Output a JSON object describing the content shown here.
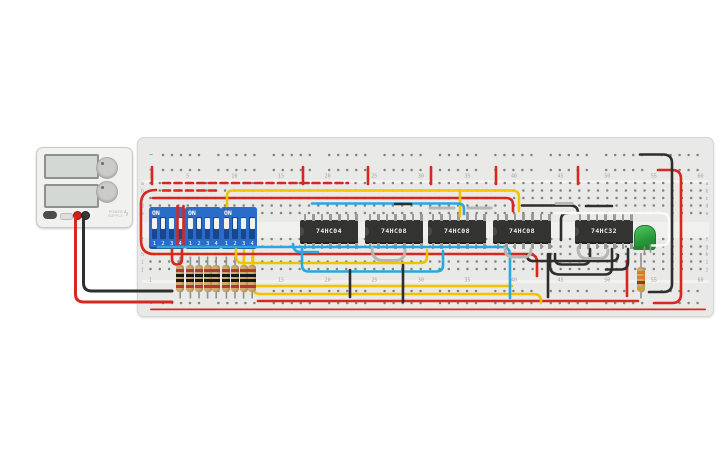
{
  "power_supply": {
    "brand_line1": "POWER",
    "brand_line2": "SUPPLY",
    "power_glyph": "ϟ"
  },
  "breadboard": {
    "column_numbers": [
      "1",
      "5",
      "10",
      "15",
      "20",
      "25",
      "30",
      "35",
      "40",
      "45",
      "50",
      "55",
      "60"
    ],
    "row_letters_top": [
      "a",
      "b",
      "c",
      "d",
      "e"
    ],
    "row_letters_bottom": [
      "f",
      "g",
      "h",
      "i",
      "j"
    ],
    "minus_symbol": "−",
    "plus_symbol": "+"
  },
  "dip_switches": [
    {
      "on_label": "ON",
      "pins": [
        "1",
        "2",
        "3",
        "4"
      ],
      "states": [
        "on",
        "on",
        "on",
        "on"
      ]
    },
    {
      "on_label": "ON",
      "pins": [
        "1",
        "2",
        "3",
        "4"
      ],
      "states": [
        "on",
        "on",
        "on",
        "on"
      ]
    },
    {
      "on_label": "ON",
      "pins": [
        "1",
        "2",
        "3",
        "4"
      ],
      "states": [
        "on",
        "on",
        "on",
        "on"
      ]
    }
  ],
  "ics": [
    {
      "label": "74HC04"
    },
    {
      "label": "74HC08"
    },
    {
      "label": "74HC08"
    },
    {
      "label": "74HC08"
    },
    {
      "label": "74HC32"
    }
  ],
  "led": {
    "color": "green"
  },
  "resistors": {
    "left_count": 9,
    "left_bands": [
      "#b03a2e",
      "#161616",
      "#161616",
      "#b03a2e"
    ],
    "right_bands": [
      "#e07b20",
      "#e07b20",
      "#7a4a12",
      "#c8a038"
    ]
  },
  "wires": [
    {
      "c": "#d6281e",
      "w": 2.6,
      "layer": "under",
      "d": "M258 301 H638"
    },
    {
      "c": "#f0c400",
      "w": 2.6,
      "layer": "under",
      "d": "M244 249 V279 Q244 286 251 286 H512"
    },
    {
      "c": "#f0c400",
      "w": 2.6,
      "layer": "under",
      "d": "M253 249 V287 Q253 294 260 294 H533 Q541 294 541 301 V303"
    },
    {
      "c": "#d6281e",
      "w": 2.6,
      "layer": "over",
      "dash": "7 4.5",
      "d": "M163 183 H348"
    },
    {
      "c": "#d6281e",
      "w": 2.6,
      "layer": "over",
      "dash": "7 4.5",
      "d": "M163 190.5 H218"
    },
    {
      "c": "#d6281e",
      "w": 2.6,
      "layer": "over",
      "d": "M153 198 H506 Q513 198 513 205 V211"
    },
    {
      "c": "#d6281e",
      "w": 2.6,
      "layer": "over",
      "d": "M156 190 Q141 190 141 204 V240 Q141 254 154 254"
    },
    {
      "c": "#d6281e",
      "w": 2.6,
      "layer": "over",
      "d": "M154 254 H528 Q537 254 537 262 V276"
    },
    {
      "c": "#d6281e",
      "w": 2.6,
      "layer": "over",
      "d": "M172 249 V258 Q172 264.5 177 264.5 Q182 264.5 182 259 V250"
    },
    {
      "c": "#d6281e",
      "w": 2.6,
      "layer": "over",
      "d": "M177.5 206 V244"
    },
    {
      "c": "#d6281e",
      "w": 2.6,
      "layer": "over",
      "d": "M183.5 206 V244"
    },
    {
      "c": "#d6281e",
      "w": 2.6,
      "layer": "over",
      "d": "M152 167 V184"
    },
    {
      "c": "#d6281e",
      "w": 2.6,
      "layer": "over",
      "d": "M303 167 V184"
    },
    {
      "c": "#d6281e",
      "w": 2.6,
      "layer": "over",
      "d": "M368 167 V184"
    },
    {
      "c": "#d6281e",
      "w": 2.6,
      "layer": "over",
      "d": "M431 167 V184"
    },
    {
      "c": "#d6281e",
      "w": 2.6,
      "layer": "over",
      "d": "M496 167 V184"
    },
    {
      "c": "#d6281e",
      "w": 2.6,
      "layer": "over",
      "d": "M578 167 V184"
    },
    {
      "c": "#d6281e",
      "w": 2.6,
      "layer": "over",
      "d": "M658 170 H672 Q681 170 681 179 V294 Q681 303 672 303 H654"
    },
    {
      "c": "#d6281e",
      "w": 3,
      "layer": "over",
      "d": "M75.5 217 V294 Q75.5 302 84 302 H172"
    },
    {
      "c": "#d6281e",
      "w": 2.6,
      "layer": "over",
      "d": "M627 261 V296"
    },
    {
      "c": "#f0c400",
      "w": 2.6,
      "layer": "over",
      "d": "M227 206 V196 Q227 190.5 233 190.5 H512 Q519 190.5 519 197 V211"
    },
    {
      "c": "#f0c400",
      "w": 2.6,
      "layer": "over",
      "d": "M460 190 V216"
    },
    {
      "c": "#f0c400",
      "w": 2.6,
      "layer": "over",
      "d": "M236 249 V256 Q236 263 242 263 H420 Q427 263 427 257 V250"
    },
    {
      "c": "#29a8e0",
      "w": 2.6,
      "layer": "over",
      "d": "M158 247 H502 Q510 247 510 255 V298"
    },
    {
      "c": "#29a8e0",
      "w": 2.6,
      "layer": "over",
      "d": "M312 203.5 H458 Q464 203.5 464 209 V214"
    },
    {
      "c": "#29a8e0",
      "w": 2.6,
      "layer": "over",
      "d": "M302 249 V265 Q302 271.5 309 271.5 H436 Q443 271.5 443 265 V251"
    },
    {
      "c": "#29a8e0",
      "w": 2.6,
      "layer": "over",
      "d": "M293 244 Q293 252 301 252 H318"
    },
    {
      "c": "#2e2e2e",
      "w": 2.6,
      "layer": "over",
      "d": "M640 154.5 H663 Q672 154.5 672 163 V284 Q672 292 663 292 H649"
    },
    {
      "c": "#2e2e2e",
      "w": 3,
      "layer": "over",
      "d": "M83.5 217 V283 Q83.5 291 92 291 H172"
    },
    {
      "c": "#2e2e2e",
      "w": 2.6,
      "layer": "over",
      "d": "M548 254 V297"
    },
    {
      "c": "#2e2e2e",
      "w": 2.6,
      "layer": "over",
      "d": "M403 265 V302"
    },
    {
      "c": "#2e2e2e",
      "w": 2.6,
      "layer": "over",
      "d": "M350 270 V297"
    },
    {
      "c": "#2e2e2e",
      "w": 2.6,
      "layer": "over",
      "d": "M527 255 Q527 261 533 261 H612 Q618 261 618 255"
    },
    {
      "c": "#2e2e2e",
      "w": 2.6,
      "layer": "over",
      "d": "M522 205.5 H570 Q578 205.5 578 213"
    },
    {
      "c": "#2e2e2e",
      "w": 2.6,
      "layer": "over",
      "d": "M586 206 H612"
    },
    {
      "c": "#2e2e2e",
      "w": 2.6,
      "layer": "over",
      "d": "M590 249 V257 Q590 264.5 583 264.5 H562 Q555 264.5 555 258 V254"
    },
    {
      "c": "#2e2e2e",
      "w": 2.6,
      "layer": "over",
      "d": "M612 249 V267 Q612 274.5 605 274.5 H560 Q550 274.5 550 266 V254"
    },
    {
      "c": "#2e2e2e",
      "w": 2.6,
      "layer": "over",
      "d": "M628 249 V262 Q628 269.5 621 269.5 H606"
    },
    {
      "c": "#2e2e2e",
      "w": 2.6,
      "layer": "over",
      "d": "M568 213 Q561 213 561 220 V240"
    },
    {
      "c": "#2e2e2e",
      "w": 2.6,
      "layer": "over",
      "d": "M395 204 H411"
    },
    {
      "c": "#b6b6b4",
      "w": 3,
      "layer": "over",
      "d": "M430 208 H454"
    },
    {
      "c": "#b6b6b4",
      "w": 3,
      "layer": "over",
      "d": "M468 208 H491"
    },
    {
      "c": "#b6b6b4",
      "w": 3,
      "layer": "over",
      "d": "M372 248 Q372 260.5 383 260.5 H395 Q405 260.5 405 250"
    },
    {
      "c": "#b6b6b4",
      "w": 3,
      "layer": "over",
      "d": "M505 248 Q505 257 513 257 H524 Q531 257 531 249"
    },
    {
      "c": "#b6b6b4",
      "w": 3,
      "layer": "over",
      "d": "M578 248 Q578 258.5 587 258.5 H599 Q608 258.5 608 250"
    },
    {
      "c": "#b6b6b4",
      "w": 3,
      "layer": "over",
      "d": "M556 203.5 H572"
    },
    {
      "c": "#fafafa",
      "w": 2.6,
      "layer": "over",
      "d": "M556 213 H661 Q669 213 669 221 V238 Q669 245.5 661 245.5 H651"
    },
    {
      "c": "#8f8f8d",
      "w": 1.6,
      "layer": "over",
      "d": "M644.5 247 V253"
    },
    {
      "c": "#8f8f8d",
      "w": 1.6,
      "layer": "over",
      "d": "M650.5 245 V252"
    }
  ]
}
